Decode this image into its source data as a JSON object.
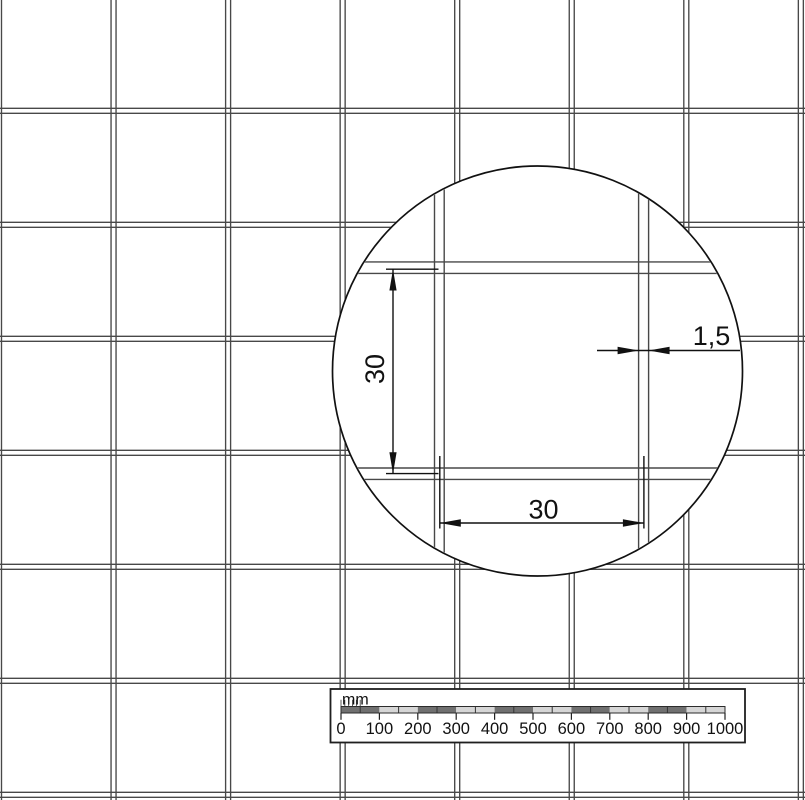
{
  "detail_view": {
    "vertical_dimension_label": "30",
    "horizontal_dimension_label": "30",
    "wire_thickness_label": "1,5"
  },
  "scale_bar": {
    "unit_label": "mm",
    "tick_labels": [
      "0",
      "100",
      "200",
      "300",
      "400",
      "500",
      "600",
      "700",
      "800",
      "900",
      "1000"
    ]
  },
  "colors": {
    "background": "#ffffff",
    "wire_line": "#484848",
    "outline": "#111111",
    "scale_segment_dark": "#707070",
    "scale_segment_light": "#d6d6d6"
  }
}
